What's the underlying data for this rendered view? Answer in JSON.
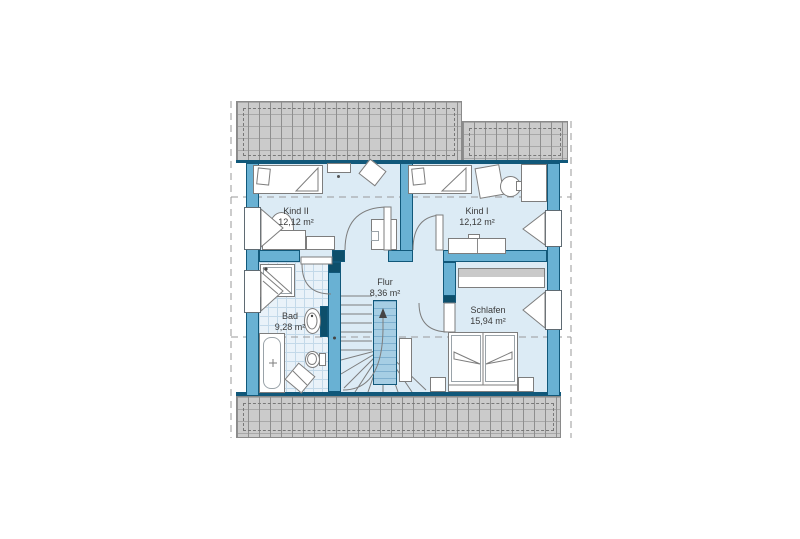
{
  "plan": {
    "type": "floor-plan",
    "floor_name": "Dachgeschoss",
    "rooms": [
      {
        "name": "Kind II",
        "area": "12,12 m²"
      },
      {
        "name": "Kind I",
        "area": "12,12 m²"
      },
      {
        "name": "Flur",
        "area": "8,36 m²"
      },
      {
        "name": "Bad",
        "area": "9,28 m²"
      },
      {
        "name": "Schlafen",
        "area": "15,94 m²"
      }
    ]
  },
  "colors": {
    "background": "#ffffff",
    "wall_fill": "#69b1d3",
    "wall_dark": "#11587a",
    "accent_dark": "#0d4f6b",
    "room_fill": "#dcebf5",
    "tile_fill": "#e9f2f9",
    "tile_line": "#c3d9e9",
    "stairwell_fill": "#a6cee4",
    "stairwell_line": "#7fb0cf",
    "roof_fill": "#cbcbcb",
    "roof_line": "#8e8e8e",
    "dash_line": "#9a9a9a",
    "furniture_line": "#7d7d7d",
    "text": "#3a3a3a"
  }
}
